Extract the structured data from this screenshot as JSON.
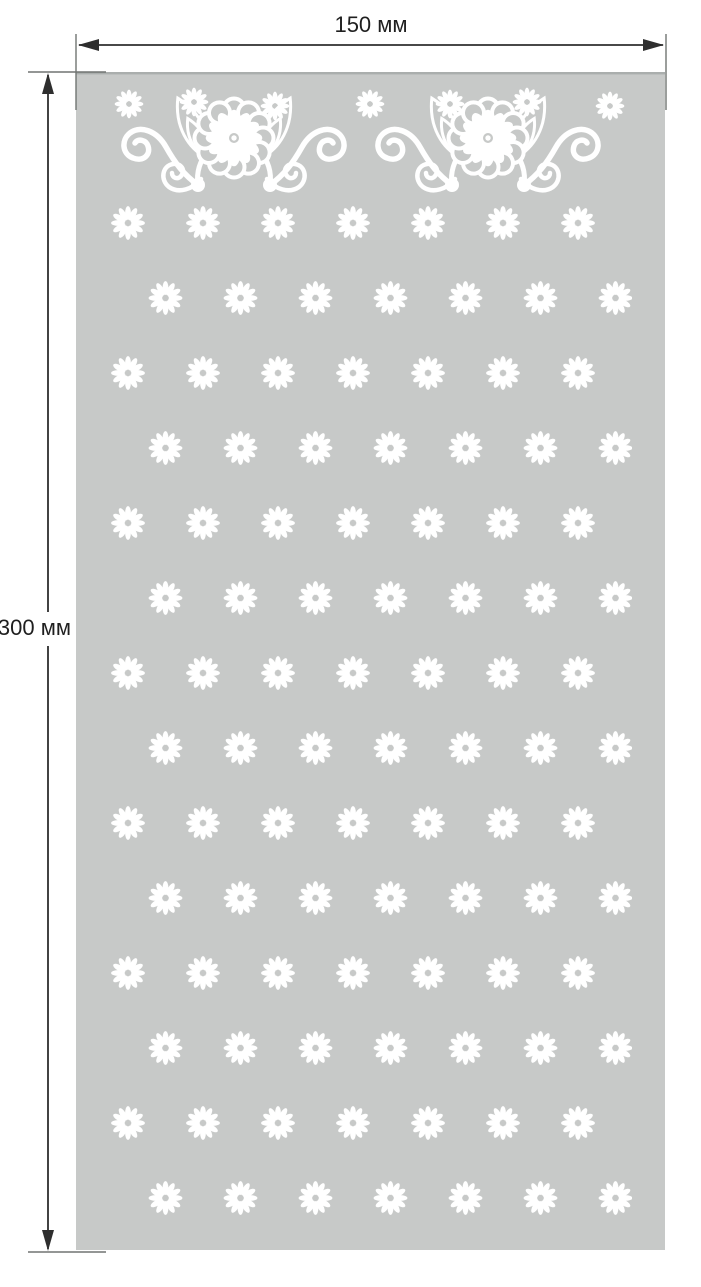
{
  "dimensions": {
    "width_label": "150 мм",
    "height_label": "300 мм",
    "width_mm": 150,
    "height_mm": 300,
    "unit": "мм"
  },
  "panel": {
    "fill_color": "#c7c9c8",
    "ornament_color": "#ffffff",
    "top_edge_color": "#aaaead"
  },
  "annotation_style": {
    "dimension_line_color": "#2e2e2e",
    "extension_line_color": "#707472",
    "label_color": "#1f1f1f"
  },
  "pattern_info": {
    "ornament": "floral border band: two mirrored motifs of a large scalloped flower with nested leaves, curled swirls with end dots, and small daisies",
    "grid": {
      "rows": 14,
      "daisies_per_row": 7,
      "horizontal_spacing_px": 75,
      "vertical_spacing_px": 75,
      "alternate_row_offset_px": 37.5
    }
  }
}
